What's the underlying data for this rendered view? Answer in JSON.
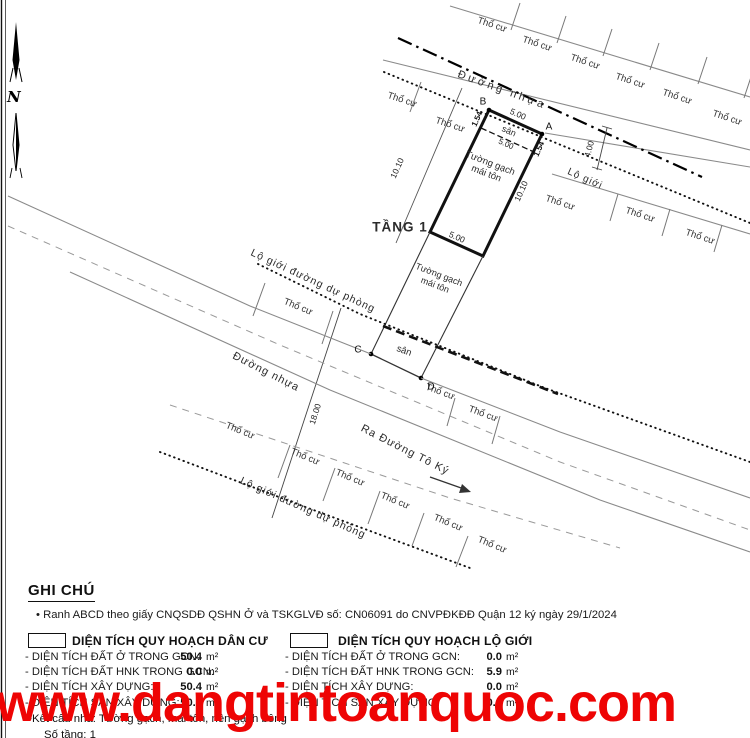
{
  "map": {
    "labels": {
      "tho_cu": "Thổ cư",
      "duong_nhua": "Đường nhựa",
      "ra_duong_to_ky": "Ra Đường Tô Ký",
      "lo_gioi": "Lộ giới",
      "lo_gioi_du_phong": "Lộ giới đường dự phòng",
      "tang_1": "TẦNG 1",
      "tuong_gach": "Tường gạch",
      "mai_ton": "mái tôn",
      "san": "sân"
    },
    "points": {
      "a": "A",
      "b": "B",
      "c": "C",
      "d": "D"
    },
    "dims": {
      "d500": "5.00",
      "d1010": "10.10",
      "d154": "1.54",
      "d400": "4.00",
      "d1800": "18.00"
    },
    "north_letter": "N"
  },
  "watermark": {
    "text": "www.dangtintoanquoc.com",
    "color": "#ee0404"
  },
  "legend": {
    "title": "GHI CHÚ",
    "bullet": "•",
    "note": "Ranh ABCD theo giấy CNQSDĐ QSHN Ở và TSKGLVĐ số: CN06091 do CNVPĐKĐĐ Quận 12 ký ngày 29/1/2024",
    "columns": [
      {
        "header": "DIỆN TÍCH QUY HOẠCH DÂN CƯ",
        "rows": [
          {
            "label": "- DIỆN TÍCH ĐẤT Ở TRONG GCN:",
            "value": "50.4",
            "unit": "m²"
          },
          {
            "label": "- DIỆN TÍCH ĐẤT HNK TRONG GCN:",
            "value": "0.0",
            "unit": "m²"
          },
          {
            "label": "- DIỆN TÍCH XÂY DỰNG:",
            "value": "50.4",
            "unit": "m²"
          },
          {
            "label": "- DIỆN TÍCH SÀN XÂY DỰNG:",
            "value": "50.4",
            "unit": "m²"
          }
        ]
      },
      {
        "header": "DIỆN TÍCH QUY HOẠCH LỘ GIỚI",
        "rows": [
          {
            "label": "- DIỆN TÍCH ĐẤT Ở TRONG GCN:",
            "value": "0.0",
            "unit": "m²"
          },
          {
            "label": "- DIỆN TÍCH ĐẤT HNK TRONG GCN:",
            "value": "5.9",
            "unit": "m²"
          },
          {
            "label": "- DIỆN TÍCH XÂY DỰNG:",
            "value": "0.0",
            "unit": "m²"
          },
          {
            "label": "- DIỆN TÍCH SÀN XÂY DỰNG:",
            "value": "0.0",
            "unit": "m²"
          }
        ]
      }
    ],
    "structure_note": "•Kết cấu nhà:  Tường gạch, mái tôn, nền gạch bông",
    "floors_note": "Số tầng: 1"
  }
}
